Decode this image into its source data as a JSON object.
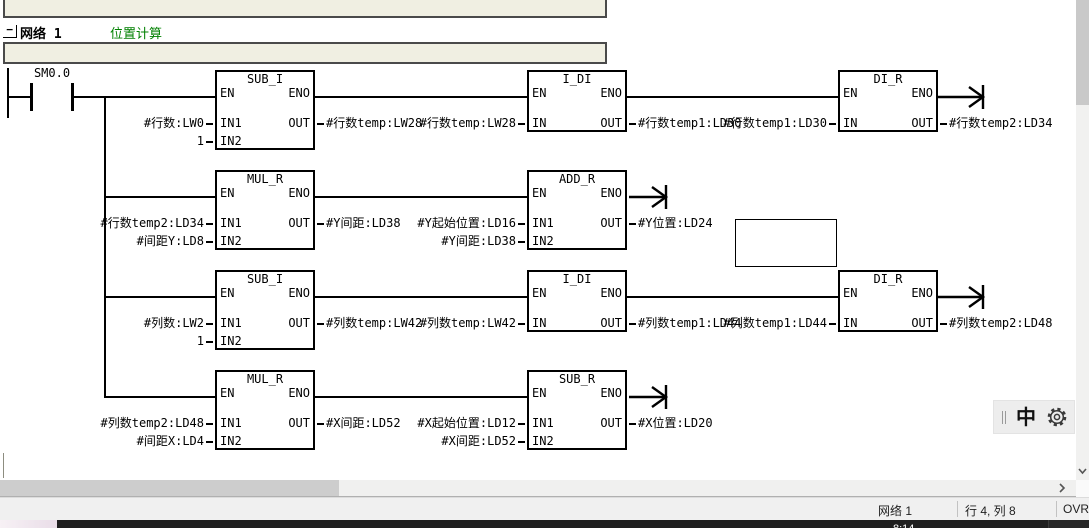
{
  "network": {
    "collapse_label": "−",
    "title": "网络 1",
    "comment": "位置计算"
  },
  "contact": {
    "label": "SM0.0"
  },
  "pins": {
    "en": "EN",
    "eno": "ENO",
    "in": "IN",
    "in1": "IN1",
    "in2": "IN2",
    "out": "OUT"
  },
  "rung1": {
    "sub_i": {
      "title": "SUB_I",
      "in1": "#行数:LW0",
      "in2": "1",
      "out": "#行数temp:LW28"
    },
    "i_di": {
      "title": "I_DI",
      "in": "#行数temp:LW28",
      "out": "#行数temp1:LD30"
    },
    "di_r": {
      "title": "DI_R",
      "in": "#行数temp1:LD30",
      "out": "#行数temp2:LD34"
    }
  },
  "rung2": {
    "mul_r": {
      "title": "MUL_R",
      "in1": "#行数temp2:LD34",
      "in2": "#间距Y:LD8",
      "out": "#Y间距:LD38"
    },
    "add_r": {
      "title": "ADD_R",
      "in1": "#Y起始位置:LD16",
      "in2": "#Y间距:LD38",
      "out": "#Y位置:LD24"
    }
  },
  "rung3": {
    "sub_i": {
      "title": "SUB_I",
      "in1": "#列数:LW2",
      "in2": "1",
      "out": "#列数temp:LW42"
    },
    "i_di": {
      "title": "I_DI",
      "in": "#列数temp:LW42",
      "out": "#列数temp1:LD44"
    },
    "di_r": {
      "title": "DI_R",
      "in": "#列数temp1:LD44",
      "out": "#列数temp2:LD48"
    }
  },
  "rung4": {
    "mul_r": {
      "title": "MUL_R",
      "in1": "#列数temp2:LD48",
      "in2": "#间距X:LD4",
      "out": "#X间距:LD52"
    },
    "sub_r": {
      "title": "SUB_R",
      "in1": "#X起始位置:LD12",
      "in2": "#X间距:LD52",
      "out": "#X位置:LD20"
    }
  },
  "ime": {
    "lang": "中"
  },
  "statusbar": {
    "network_label": "网络 1",
    "cursor_position": "行 4, 列 8",
    "overwrite_mode": "OVR"
  },
  "taskbar": {
    "clock": "8:14"
  },
  "colors": {
    "comment_bg": "#f0efe2",
    "comment_green": "#008000",
    "ladder": "#000000",
    "statusbar_bg": "#f0f0f0",
    "taskbar_bg": "#1f1f1f"
  }
}
